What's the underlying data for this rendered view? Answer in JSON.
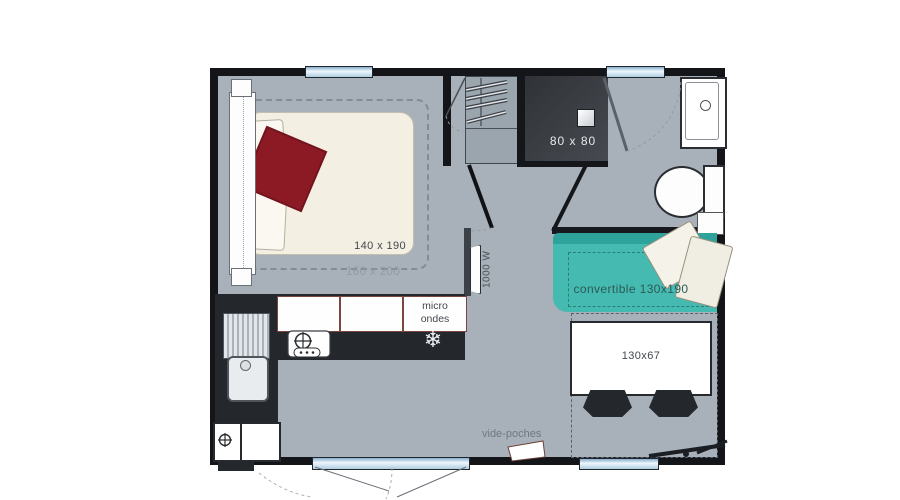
{
  "title": "mobile-home floor plan",
  "bedroom": {
    "bed_size": "140 x 190",
    "bed_alt_size": "160 x 200",
    "heater_power": "1000 W"
  },
  "bathroom": {
    "shower_size": "80 x 80"
  },
  "kitchen": {
    "microwave_line1": "micro",
    "microwave_line2": "ondes",
    "freezer_icon": "❄"
  },
  "living": {
    "sofa_label": "convertible 130x190",
    "table_size": "130x67",
    "shelf_label": "vide-poches"
  },
  "colors": {
    "floor": "#a8b0b9",
    "wall": "#131519",
    "sofa_teal": "#45bab1",
    "bed_cream": "#f3efe2",
    "blanket_red": "#8c1a25",
    "counter_dark": "#24272c",
    "window_blue": "#aecde2",
    "shower_dark": "#3d4147"
  }
}
